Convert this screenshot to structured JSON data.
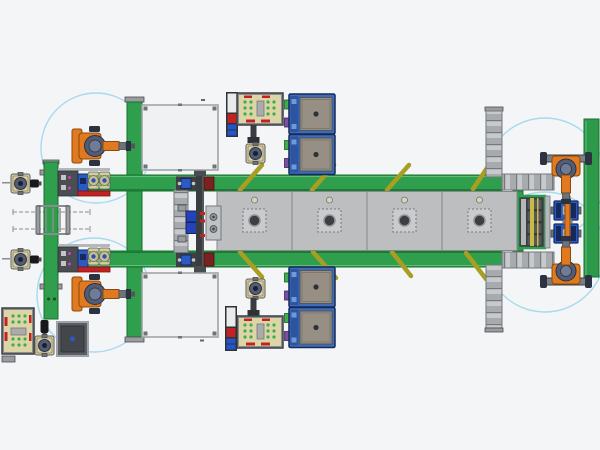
{
  "scene": {
    "label": "factory-assembly-line-top-view",
    "width": 600,
    "height": 450
  },
  "colors": {
    "bg": "#f4f5f6",
    "rail-green": "#2f9e4d",
    "rail-green-dark": "#17702f",
    "rail-green-light": "#63bd79",
    "wall-green": "#2c9a4a",
    "pallet": "#bcbec0",
    "pallet-border": "#85888b",
    "pallet-inner": "#c9cbcd",
    "white-machine": "#f0f1f2",
    "machine-border": "#9aa0a4",
    "machine-corner": "#6f7478",
    "ladder-border": "#75797d",
    "robot-orange": "#e0791f",
    "robot-orange-dark": "#8a4a0d",
    "robot-slate": "#525c74",
    "robot-slate-dark": "#2b3242",
    "robot-gray": "#6d7378",
    "blue-machine": "#3e6cb5",
    "blue-machine-dark": "#2c54a0",
    "panel-tan": "#978f84",
    "fixture-beige": "#ddd5a8",
    "fixture-border": "#3c4043",
    "dot-green": "#3fae4a",
    "mark-red": "#c32222",
    "accent-blue": "#2a5bc4",
    "accent-navy": "#16295c",
    "envelope": "#a7daf0",
    "brace": "#a89e22",
    "column-dark": "#3a3d40",
    "box-gray": "#5b5f63",
    "magenta": "#cc44aa",
    "purple": "#7a4fa0",
    "steel": "#9a9da0",
    "steel-dark": "#4a4d50",
    "beige-circle": "#d8d2b8",
    "rack-yellow": "#c9b945"
  },
  "line": {
    "pallet_y": 191.5,
    "pallet_w": 75,
    "pallet_h": 59,
    "pallets": [
      {
        "x": 217
      },
      {
        "x": 292
      },
      {
        "x": 367
      },
      {
        "x": 442
      }
    ]
  },
  "braces": [
    {
      "x1": 240,
      "y1": 190,
      "x2": 262,
      "y2": 165
    },
    {
      "x1": 312,
      "y1": 190,
      "x2": 334,
      "y2": 165
    },
    {
      "x1": 387,
      "y1": 190,
      "x2": 409,
      "y2": 165
    },
    {
      "x1": 473,
      "y1": 189,
      "x2": 491,
      "y2": 162
    },
    {
      "x1": 240,
      "y1": 252,
      "x2": 262,
      "y2": 277
    },
    {
      "x1": 313,
      "y1": 252,
      "x2": 336,
      "y2": 278
    },
    {
      "x1": 392,
      "y1": 252,
      "x2": 411,
      "y2": 276
    },
    {
      "x1": 466,
      "y1": 253,
      "x2": 486,
      "y2": 279
    }
  ],
  "envelopes": [
    {
      "cx": 96,
      "cy": 148,
      "r": 55
    },
    {
      "cx": 94,
      "cy": 295,
      "r": 57
    },
    {
      "cx": 545,
      "cy": 178,
      "r": 60
    },
    {
      "cx": 545,
      "cy": 252,
      "r": 60
    }
  ],
  "robots": [
    {
      "x": 95,
      "y": 146,
      "rot": 0,
      "style": "base"
    },
    {
      "x": 95,
      "y": 294,
      "rot": 0,
      "style": "base"
    },
    {
      "x": 566,
      "y": 169,
      "rot": 90,
      "style": "crossbar"
    },
    {
      "x": 566,
      "y": 271,
      "rot": -90,
      "style": "crossbar"
    }
  ],
  "inventory": {
    "robots": 4,
    "conveyor_pallets": 4,
    "white_press_machines": 2,
    "blue_machine_stacks": 2,
    "blue_machines_per_stack": 2,
    "fixture_plates": 3,
    "inspection_devices": 5,
    "work_envelope_circles": 4,
    "diagonal_braces": 8
  }
}
